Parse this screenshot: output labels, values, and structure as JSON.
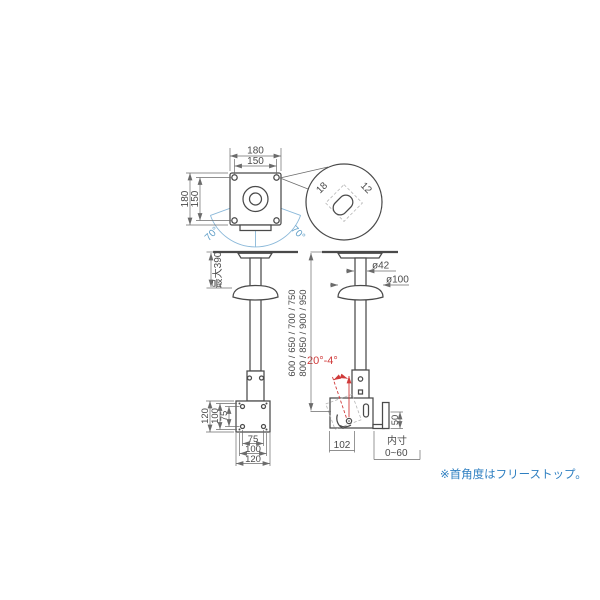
{
  "top_view": {
    "dim_top_outer": "180",
    "dim_top_inner": "150",
    "dim_left_outer": "180",
    "dim_left_inner": "150",
    "swivel_left": "70°",
    "swivel_right": "70°",
    "slot_length": "18",
    "slot_width": "12"
  },
  "front_view": {
    "max_drop": "最大390",
    "left_dims": [
      "120",
      "100",
      "75"
    ],
    "bottom_dims": [
      "75",
      "100",
      "120"
    ]
  },
  "side_view": {
    "pipe_diameter": "ø42",
    "cover_diameter": "ø100",
    "tilt_range": "20°-4°",
    "lengths_line1": "600 / 650 / 700 / 750",
    "lengths_line2": "800 / 850 / 900 / 950",
    "bracket_depth": "102",
    "hook_height": "50",
    "inner_label": "内寸",
    "inner_range": "0~60"
  },
  "note": {
    "text": "※首角度はフリーストップ。"
  },
  "colors": {
    "line": "#4a4a4a",
    "dimension": "#6b6b6b",
    "accent_blue": "#5f9ec7",
    "accent_red": "#d03a3a",
    "note_blue": "#2e7fc1"
  }
}
